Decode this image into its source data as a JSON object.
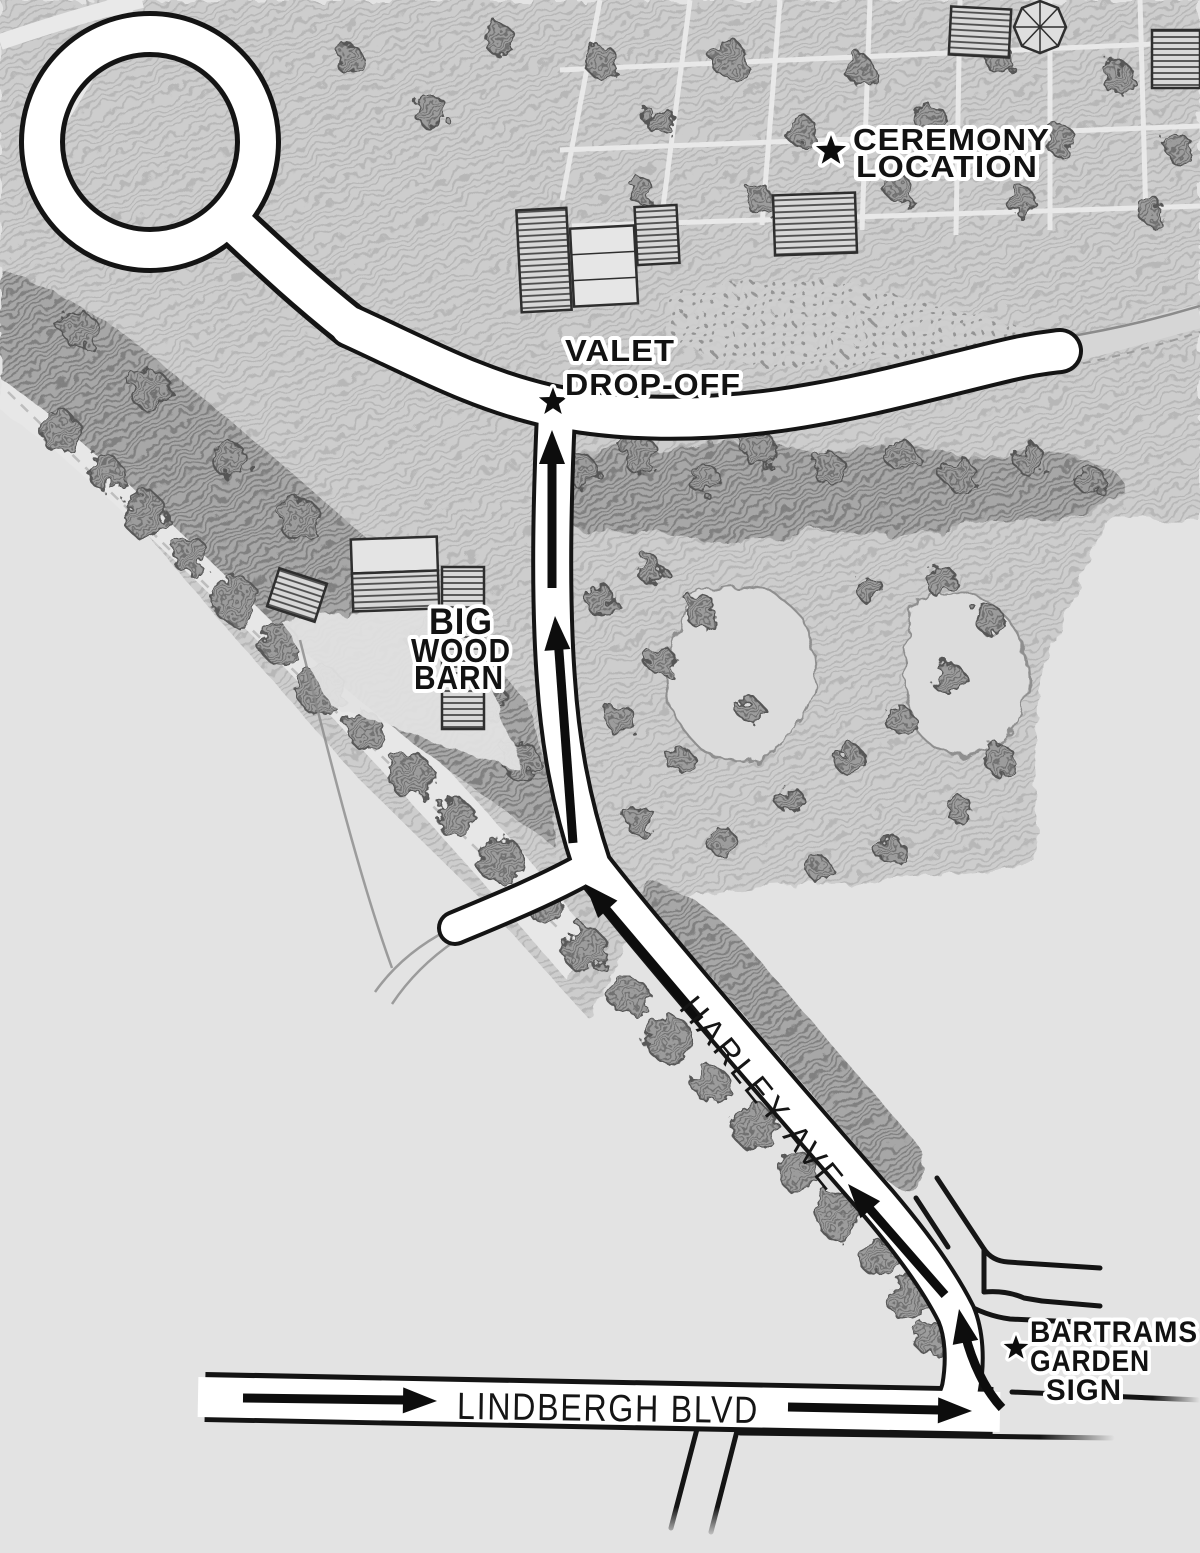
{
  "map": {
    "description": "Hand-drawn driving directions map to a garden wedding",
    "paper_color": "#e3e3e3",
    "road_fill": "#ffffff",
    "road_casing": "#141414",
    "ink_color": "#141414",
    "halo_color": "#ffffff",
    "marker_symbol": "star"
  },
  "destinations": {
    "ceremony": {
      "line1": "CEREMONY",
      "line2": "LOCATION",
      "marker": "star"
    },
    "valet": {
      "line1": "VALET",
      "line2": "DROP-OFF",
      "marker": "star"
    },
    "big_wood_barn": {
      "line1": "BIG",
      "line2": "WOOD",
      "line3": "BARN"
    },
    "bartrams_sign": {
      "line1": "BARTRAMS",
      "line2": "GARDEN",
      "line3": "SIGN",
      "marker": "star"
    }
  },
  "roads": {
    "harley": "HARLEY AVE",
    "lindbergh": "LINDBERGH BLVD"
  },
  "route": {
    "arrows": [
      {
        "on": "LINDBERGH BLVD",
        "direction": "east"
      },
      {
        "on": "LINDBERGH BLVD",
        "direction": "east"
      },
      {
        "on": "HARLEY AVE",
        "direction": "north (turn from Lindbergh Blvd)"
      },
      {
        "on": "HARLEY AVE",
        "direction": "northwest"
      },
      {
        "on": "HARLEY AVE",
        "direction": "northwest"
      },
      {
        "on": "valet driveway",
        "direction": "north"
      },
      {
        "on": "valet driveway",
        "direction": "north"
      }
    ]
  }
}
